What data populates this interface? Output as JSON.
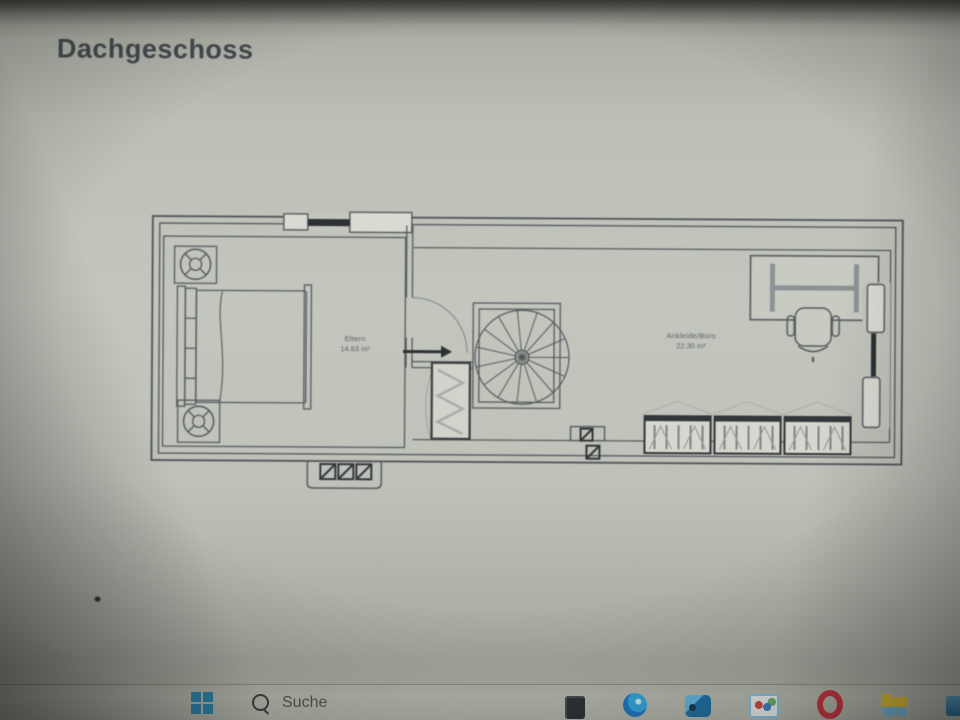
{
  "page": {
    "title": "Dachgeschoss"
  },
  "floor_plan": {
    "rooms": [
      {
        "name": "Eltern",
        "area": "14.63 m²"
      },
      {
        "name": "Ankleide/Büro",
        "area": "22.30 m²"
      }
    ],
    "furniture_icons": [
      "nightstand-lamp",
      "double-bed",
      "door-swing-arrow",
      "spiral-staircase",
      "dresser",
      "skylight-band",
      "vent-shaft",
      "desk",
      "office-chair",
      "wardrobe-rail",
      "roof-window"
    ]
  },
  "taskbar": {
    "search": {
      "placeholder": "Suche"
    },
    "icons": [
      {
        "name": "start-windows"
      },
      {
        "name": "search-magnifier"
      },
      {
        "name": "dark-pinned-app"
      },
      {
        "name": "edge-browser"
      },
      {
        "name": "blue-box-app"
      },
      {
        "name": "photos-app"
      },
      {
        "name": "opera-browser"
      },
      {
        "name": "file-explorer"
      },
      {
        "name": "blue-app"
      }
    ]
  },
  "colors": {
    "screen_bg": "#c3c6bd",
    "line_ink": "#4f5257",
    "dark_fill": "#2d3034",
    "title_text": "#43464b",
    "taskbar_bg": "#b8bbb1",
    "start_blue": "#2e86b2",
    "opera_red": "#c9333e",
    "folder_yellow": "#e4c337"
  }
}
